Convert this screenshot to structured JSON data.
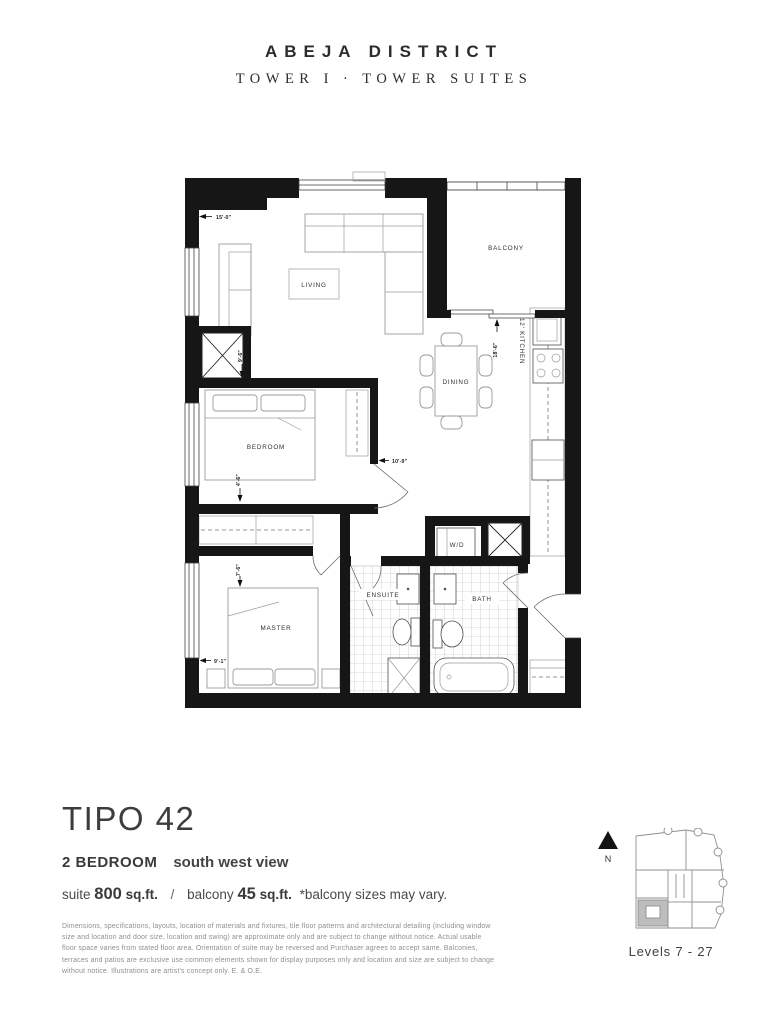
{
  "header": {
    "brand": "ABEJA DISTRICT",
    "subtitle": "TOWER I · TOWER SUITES"
  },
  "floorplan": {
    "rooms": {
      "living": "LIVING",
      "balcony": "BALCONY",
      "dining": "DINING",
      "bedroom": "BEDROOM",
      "kitchen": "12' KITCHEN",
      "wd": "W/D",
      "ensuite": "ENSUITE",
      "bath": "BATH",
      "master": "MASTER"
    },
    "dims": {
      "living_width": "15'-0\"",
      "living_depth": "9'-6\"",
      "kitchen_dining_length": "18'-6\"",
      "bedroom_width": "10'-9\"",
      "bedroom_depth": "4'-6\"",
      "master_depth": "7'-6\"",
      "master_width": "9'-1\""
    }
  },
  "details": {
    "plan_name": "TIPO 42",
    "bedrooms": "2 BEDROOM",
    "view": "south west view",
    "suite_label": "suite",
    "suite_area": "800",
    "suite_unit": "sq.ft.",
    "separator": "/",
    "balcony_label": "balcony",
    "balcony_area": "45",
    "balcony_unit": "sq.ft.",
    "balcony_note": "*balcony sizes may vary."
  },
  "disclaimer": "Dimensions, specifications, layouts, location of materials and fixtures, tile floor patterns and architectural detailing (including window size and location and door size, location and swing) are approximate only and are subject to change without notice. Actual usable floor space varies from stated floor area. Orientation of suite may be reversed and Purchaser agrees to accept same. Balconies, terraces and patios are exclusive use common elements shown for display purposes only and location and size are subject to change without notice. Illustrations are artist's concept only. E. & O.E.",
  "keyplan": {
    "north_label": "N",
    "levels": "Levels 7 - 27",
    "highlight_color": "#bdbdbd"
  }
}
